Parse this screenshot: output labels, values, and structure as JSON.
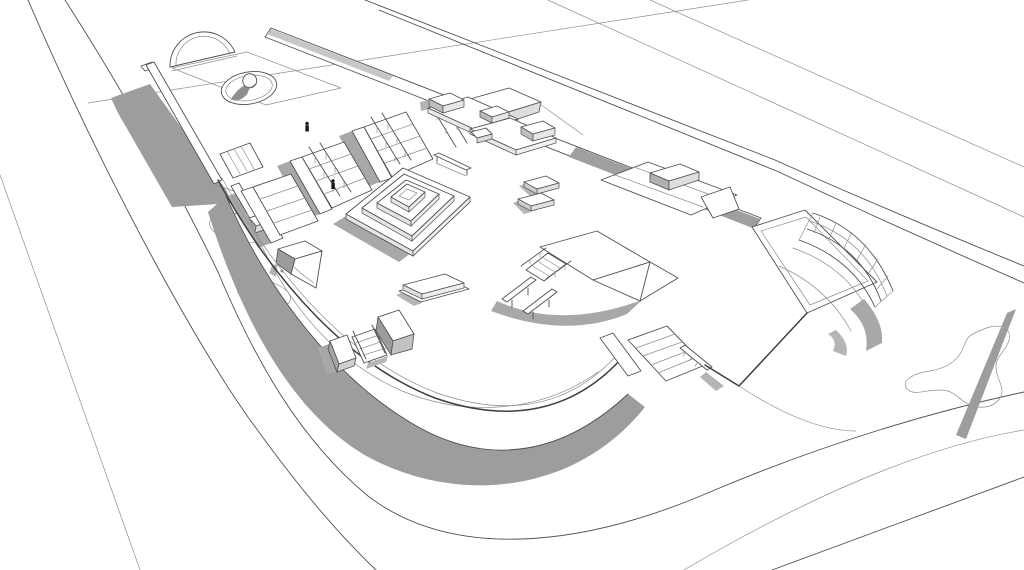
{
  "meta": {
    "title": "Skatepark concept - 3D architectural line rendering",
    "view": "aerial three-quarter view of a corner-lot skate plaza",
    "style": "monochrome sketch render, white surfaces with gray cast shadows"
  },
  "canvas": {
    "width": 1024,
    "height": 570,
    "background": "#ffffff"
  },
  "palette": {
    "line": "#4f4f4f",
    "line_strong": "#3e3e3e",
    "line_light": "#8f8f8f",
    "surface": "#ffffff",
    "shadow": "#9d9d9d",
    "shadow_medium": "#a8a8a8",
    "shadow_soft": "#b5b5b5",
    "face_shaded": "#c6c6c6"
  },
  "scene": {
    "labels": {
      "viewport": "3D model viewport",
      "streets": "Street and curb lines around the corner lot",
      "sidewalk": "Curved sidewalk edge around the plaza",
      "planting_beds": "Oval planting beds on the sidewalk",
      "upper_deck": "Raised upper deck of the plaza",
      "quarter_dome": "Quarter-dome wall feature on the deck",
      "ball_bowl": "Elliptical bowl with sphere feature",
      "deck_ledge": "Long grind ledge on the deck left edge",
      "deck_shadow": "Cast shadow of the raised deck",
      "deck_stair_cut": "Small stair cut through the deck ledge",
      "stair_cascade": "Wide stair cascade with dividing ledges",
      "handrails": "Stair handrails",
      "stair_block": "Ledge block at the top of the stair cascade",
      "top_ledge": "Long hubba ledge along the upper plaza edge",
      "a_frame": "A-frame bank with grind box",
      "corner_quarterpipe": "Curved corner quarterpipe with safety fence",
      "pyramid": "Stacked-square pyramid ledge stack",
      "manual_pads": "Manual pad combo with grind boxes",
      "flat_rail": "Low flat rail",
      "bench_steps": "Two-step bench ledges",
      "funbox": "Funbox platform with stairs",
      "funbox_rails": "Flat grind rails off the funbox",
      "small_quarterpipe": "Small quarterpipe block",
      "street_bench": "Flat bench ledge",
      "flow_bank": "Long curved flow bank along the lower edge",
      "bank_shadow": "Cast shadow of the curved flow bank",
      "entry_blocks": "Entry blocks and steps through the bank",
      "lower_stairs": "Lower stair set with hand rail",
      "pad_edge": "Concrete pad edge lines",
      "landscape_bed": "Organic landscape bed outline",
      "pole_shadow": "Cast shadow of a light pole",
      "figures": "Tiny figure markers for scale"
    }
  }
}
